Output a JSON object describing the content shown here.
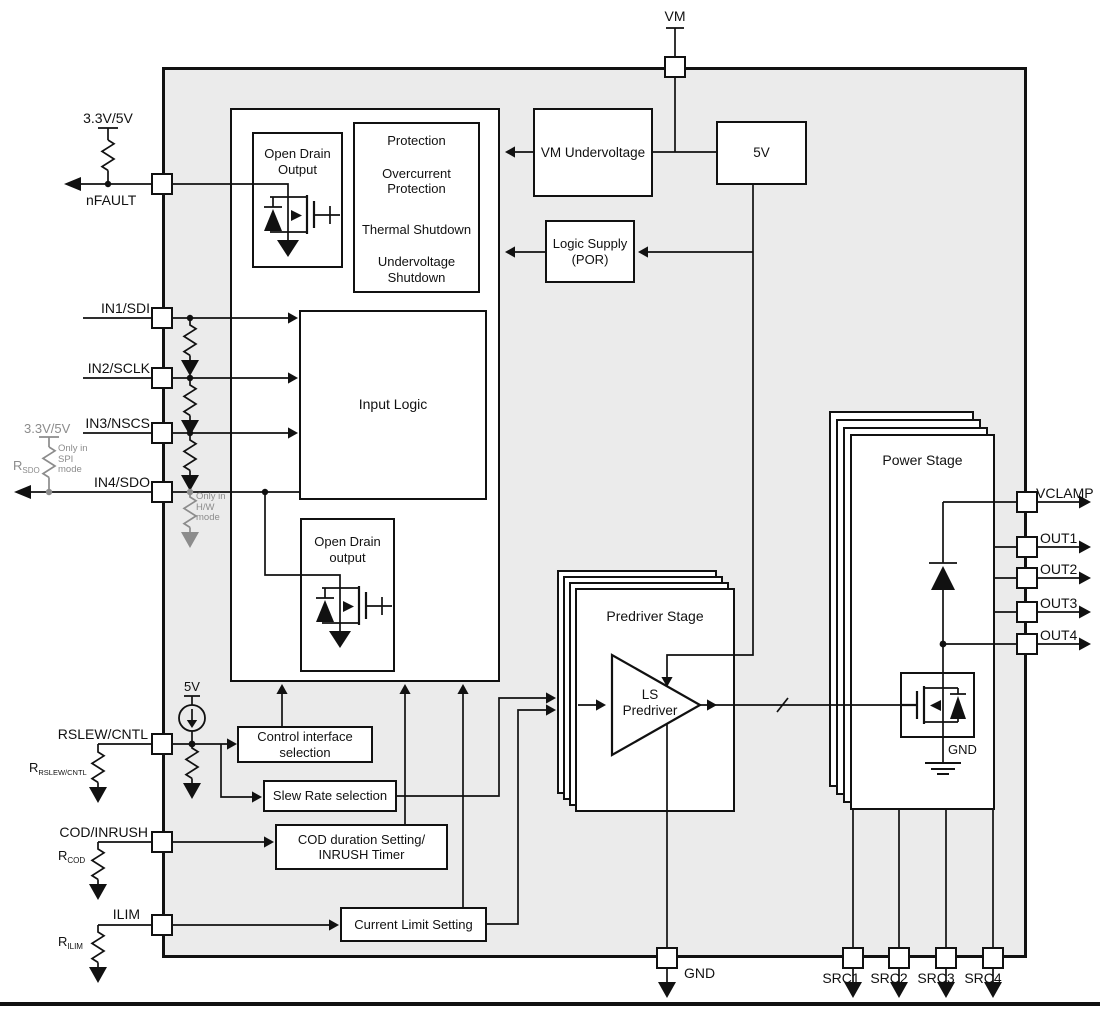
{
  "pins": {
    "vm": "VM",
    "nfault": "nFAULT",
    "in1": "IN1/SDI",
    "in2": "IN2/SCLK",
    "in3": "IN3/NSCS",
    "in4": "IN4/SDO",
    "rslew_cntl": "RSLEW/CNTL",
    "cod_inrush": "COD/INRUSH",
    "ilim": "ILIM",
    "gnd": "GND",
    "src1": "SRC1",
    "src2": "SRC2",
    "src3": "SRC3",
    "src4": "SRC4",
    "vclamp": "VCLAMP",
    "out1": "OUT1",
    "out2": "OUT2",
    "out3": "OUT3",
    "out4": "OUT4"
  },
  "external": {
    "nfault_supply": "3.3V/5V",
    "sdo_supply": "3.3V/5V",
    "rsdo_base": "R",
    "rsdo_sub": "SDO",
    "rslew_base": "R",
    "rslew_sub": "RSLEW/CNTL",
    "rcod_base": "R",
    "rcod_sub": "COD",
    "rilim_base": "R",
    "rilim_sub": "ILIM",
    "spi_note": "Only in\nSPI\nmode",
    "hw_note": "Only in\nH/W\nmode"
  },
  "blocks": {
    "open_drain_output_top": "Open Drain\nOutput",
    "protection_items": [
      "Protection",
      "Overcurrent\nProtection",
      "Thermal Shutdown",
      "Undervoltage\nShutdown"
    ],
    "vm_undervoltage": "VM Undervoltage",
    "five_v": "5V",
    "logic_supply": "Logic Supply\n(POR)",
    "input_logic": "Input Logic",
    "open_drain_output_bottom": "Open Drain\noutput",
    "control_interface": "Control interface\nselection",
    "slew_rate": "Slew Rate selection",
    "cod_timer": "COD duration Setting/\nINRUSH Timer",
    "current_limit": "Current Limit Setting",
    "predriver_stage": "Predriver Stage",
    "ls_predriver": "LS\nPredriver",
    "power_stage": "Power Stage",
    "internal_5v": "5V",
    "internal_gnd": "GND"
  },
  "colors": {
    "chip_fill": "#ebebeb",
    "line": "#111111",
    "gray": "#8c8c8c"
  }
}
